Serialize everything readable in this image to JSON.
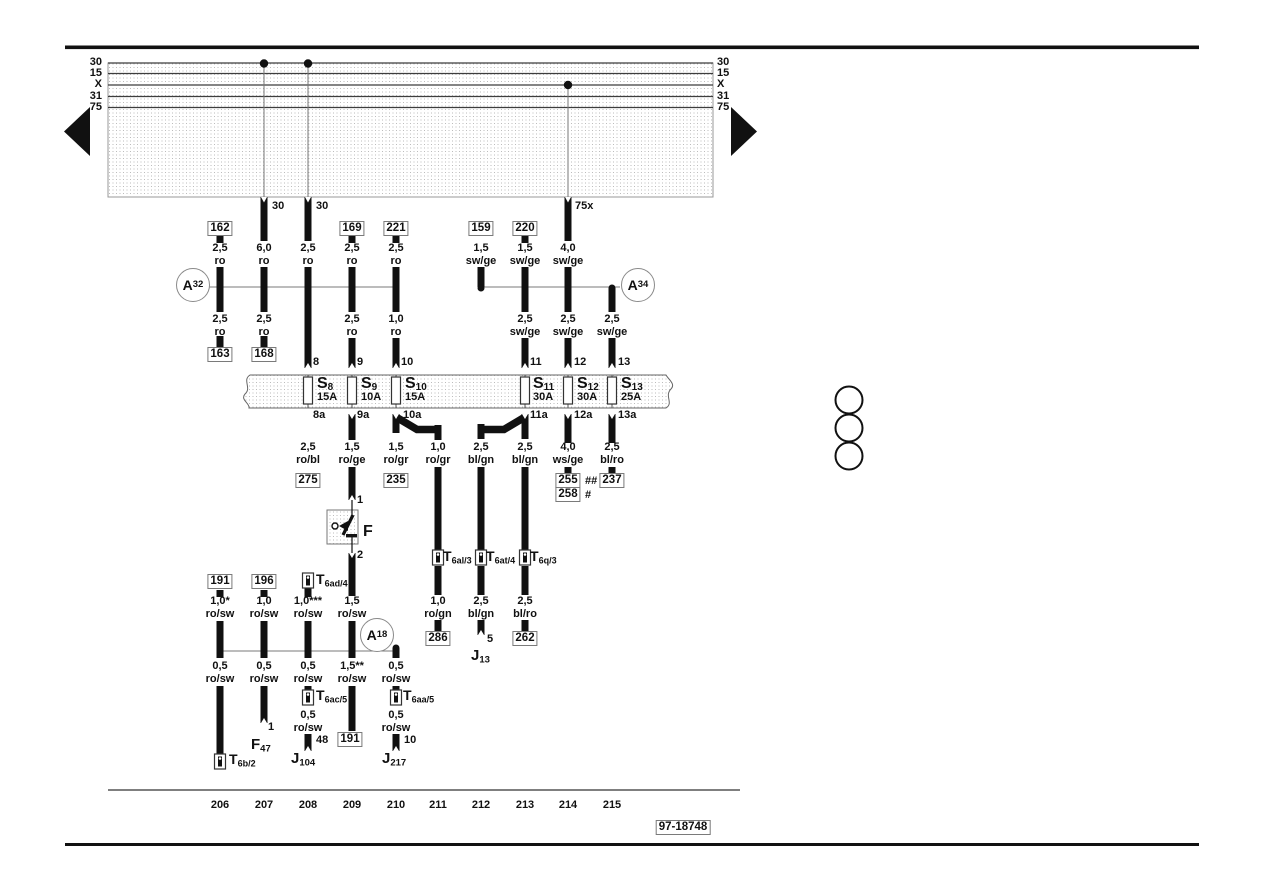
{
  "page": {
    "plate": "97-18748"
  },
  "rails": {
    "left": [
      "30",
      "15",
      "X",
      "31",
      "75"
    ],
    "right": [
      "30",
      "15",
      "X",
      "31",
      "75"
    ]
  },
  "exits": [
    "30",
    "30",
    "75x"
  ],
  "nodes": {
    "a32": {
      "m": "A",
      "s": "32"
    },
    "a34": {
      "m": "A",
      "s": "34"
    },
    "a18": {
      "m": "A",
      "s": "18"
    }
  },
  "refs": {
    "b162": "162",
    "b169": "169",
    "b221": "221",
    "b159": "159",
    "b220": "220",
    "b163": "163",
    "b168": "168",
    "b275": "275",
    "b235": "235",
    "b255": "255",
    "b255m": "##",
    "b258": "258",
    "b258m": "#",
    "b237": "237",
    "b286": "286",
    "b262": "262",
    "b191a": "191",
    "b196": "196",
    "b191b": "191"
  },
  "wires": {
    "w1u": [
      "2,5",
      "ro"
    ],
    "w2u": [
      "6,0",
      "ro"
    ],
    "w3u": [
      "2,5",
      "ro"
    ],
    "w4u": [
      "2,5",
      "ro"
    ],
    "w5u": [
      "2,5",
      "ro"
    ],
    "w7u": [
      "1,5",
      "sw/ge"
    ],
    "w8u": [
      "1,5",
      "sw/ge"
    ],
    "w9u": [
      "4,0",
      "sw/ge"
    ],
    "w1l": [
      "2,5",
      "ro"
    ],
    "w2l": [
      "2,5",
      "ro"
    ],
    "w4l": [
      "2,5",
      "ro"
    ],
    "w5l": [
      "1,0",
      "ro"
    ],
    "w8l": [
      "2,5",
      "sw/ge"
    ],
    "w9l": [
      "2,5",
      "sw/ge"
    ],
    "w10l": [
      "2,5",
      "sw/ge"
    ],
    "f3": [
      "2,5",
      "ro/bl"
    ],
    "f4": [
      "1,5",
      "ro/ge"
    ],
    "f5": [
      "1,5",
      "ro/gr"
    ],
    "f6": [
      "1,0",
      "ro/gr"
    ],
    "f7": [
      "2,5",
      "bl/gn"
    ],
    "f8": [
      "2,5",
      "bl/gn"
    ],
    "f9": [
      "4,0",
      "ws/ge"
    ],
    "f10": [
      "2,5",
      "bl/ro"
    ],
    "m1u": [
      "1,0*",
      "ro/sw"
    ],
    "m2u": [
      "1,0",
      "ro/sw"
    ],
    "m3u": [
      "1,0***",
      "ro/sw"
    ],
    "m4u": [
      "1,5",
      "ro/sw"
    ],
    "r6": [
      "1,0",
      "ro/gn"
    ],
    "r7": [
      "2,5",
      "bl/gn"
    ],
    "r8": [
      "2,5",
      "bl/ro"
    ],
    "m1l": [
      "0,5",
      "ro/sw"
    ],
    "m2l": [
      "0,5",
      "ro/sw"
    ],
    "m3l": [
      "0,5",
      "ro/sw"
    ],
    "m4l": [
      "1,5**",
      "ro/sw"
    ],
    "m5l": [
      "0,5",
      "ro/sw"
    ],
    "m3b": [
      "0,5",
      "ro/sw"
    ],
    "m5b": [
      "0,5",
      "ro/sw"
    ]
  },
  "fuses": [
    {
      "m": "S",
      "s": "8",
      "a": "15A",
      "t": "8",
      "b": "8a"
    },
    {
      "m": "S",
      "s": "9",
      "a": "10A",
      "t": "9",
      "b": "9a"
    },
    {
      "m": "S",
      "s": "10",
      "a": "15A",
      "t": "10",
      "b": "10a"
    },
    {
      "m": "S",
      "s": "11",
      "a": "30A",
      "t": "11",
      "b": "11a"
    },
    {
      "m": "S",
      "s": "12",
      "a": "30A",
      "t": "12",
      "b": "12a"
    },
    {
      "m": "S",
      "s": "13",
      "a": "25A",
      "t": "13",
      "b": "13a"
    }
  ],
  "conns": {
    "t6al3": {
      "m": "T",
      "s": "6al/3"
    },
    "t6at4": {
      "m": "T",
      "s": "6at/4"
    },
    "t6q3": {
      "m": "T",
      "s": "6q/3"
    },
    "t6ad4": {
      "m": "T",
      "s": "6ad/4"
    },
    "t6ac5": {
      "m": "T",
      "s": "6ac/5"
    },
    "t6aa5": {
      "m": "T",
      "s": "6aa/5"
    },
    "t6b2": {
      "m": "T",
      "s": "6b/2"
    }
  },
  "comps": {
    "f": "F",
    "f47": {
      "m": "F",
      "s": "47"
    },
    "j104": {
      "m": "J",
      "s": "104"
    },
    "j217": {
      "m": "J",
      "s": "217"
    },
    "j13": {
      "m": "J",
      "s": "13"
    }
  },
  "terms": {
    "f1": "1",
    "f2": "2",
    "f47": "1",
    "j104": "48",
    "j217": "10",
    "j13": "5"
  },
  "tracks": [
    "206",
    "207",
    "208",
    "209",
    "210",
    "211",
    "212",
    "213",
    "214",
    "215"
  ]
}
